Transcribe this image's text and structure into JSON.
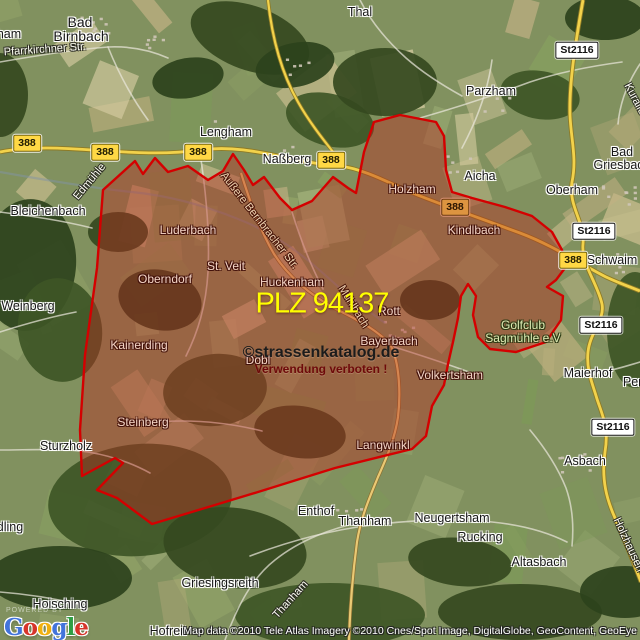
{
  "map": {
    "plz_label": {
      "text": "PLZ 94137"
    },
    "watermark": {
      "line1": "©strassenkatalog.de",
      "line2": "Verwendung verboten !"
    },
    "attribution": "Map data ©2010 Tele Atlas  Imagery ©2010 Cnes/Spot Image, DigitalGlobe, GeoContent, GeoEye",
    "google": {
      "powered": "POWERED BY",
      "letters": [
        [
          "G",
          "#4274db"
        ],
        [
          "o",
          "#d7352a"
        ],
        [
          "o",
          "#f1b10f"
        ],
        [
          "g",
          "#4274db"
        ],
        [
          "l",
          "#2f9e44"
        ],
        [
          "e",
          "#d7352a"
        ]
      ]
    },
    "colors": {
      "boundary_stroke": "#d40000",
      "boundary_fill": "rgba(185,40,30,0.42)",
      "road_primary": "#f2d24b",
      "plz_text": "#ffff00",
      "badge_yellow": "#ffd845",
      "badge_white": "#ffffff"
    },
    "labels": [
      {
        "t": "ham",
        "x": 9,
        "y": 34,
        "s": "dark"
      },
      {
        "t": "Bad",
        "x": 80,
        "y": 22,
        "s": "dark",
        "fs": 14
      },
      {
        "t": "Birnbach",
        "x": 81,
        "y": 36,
        "s": "dark",
        "fs": 14
      },
      {
        "t": "Pfarrkirchner Str.",
        "x": 45,
        "y": 50,
        "s": "street",
        "r": -4
      },
      {
        "t": "Thal",
        "x": 360,
        "y": 12,
        "s": "dark"
      },
      {
        "t": "Parzham",
        "x": 491,
        "y": 91,
        "s": "dark"
      },
      {
        "t": "Lengham",
        "x": 226,
        "y": 132,
        "s": "dark"
      },
      {
        "t": "Naßberg",
        "x": 287,
        "y": 159,
        "s": "dark"
      },
      {
        "t": "Aicha",
        "x": 480,
        "y": 176,
        "s": "dark"
      },
      {
        "t": "Oberham",
        "x": 572,
        "y": 190,
        "s": "dark"
      },
      {
        "t": "Bad",
        "x": 622,
        "y": 152,
        "s": "dark"
      },
      {
        "t": "Griesbach",
        "x": 622,
        "y": 165,
        "s": "dark"
      },
      {
        "t": "Kurallee",
        "x": 636,
        "y": 102,
        "s": "street",
        "r": 62
      },
      {
        "t": "Schwaim",
        "x": 612,
        "y": 260,
        "s": "dark"
      },
      {
        "t": "Bleichenbach",
        "x": 48,
        "y": 211,
        "s": "dark"
      },
      {
        "t": "Edmühle",
        "x": 90,
        "y": 182,
        "s": "street",
        "r": -50
      },
      {
        "t": "Weinberg",
        "x": 28,
        "y": 306,
        "s": "dark"
      },
      {
        "t": "Maierhof",
        "x": 588,
        "y": 373,
        "s": "dark"
      },
      {
        "t": "Pen",
        "x": 634,
        "y": 382,
        "s": "dark"
      },
      {
        "t": "Sturzholz",
        "x": 66,
        "y": 446,
        "s": "dark"
      },
      {
        "t": "Asbach",
        "x": 585,
        "y": 461,
        "s": "dark"
      },
      {
        "t": "Enthof",
        "x": 316,
        "y": 511,
        "s": "dark"
      },
      {
        "t": "Thanham",
        "x": 365,
        "y": 521,
        "s": "dark"
      },
      {
        "t": "Neugertsham",
        "x": 452,
        "y": 518,
        "s": "dark"
      },
      {
        "t": "Rucking",
        "x": 480,
        "y": 537,
        "s": "dark"
      },
      {
        "t": "Altasbach",
        "x": 539,
        "y": 562,
        "s": "dark"
      },
      {
        "t": "Griesingsreith",
        "x": 220,
        "y": 583,
        "s": "dark"
      },
      {
        "t": "Hoisching",
        "x": 60,
        "y": 604,
        "s": "dark"
      },
      {
        "t": "Hofreit",
        "x": 168,
        "y": 631,
        "s": "dark"
      },
      {
        "t": "dling",
        "x": 10,
        "y": 527,
        "s": "dark"
      },
      {
        "t": "Thanham",
        "x": 291,
        "y": 600,
        "s": "street",
        "r": -48
      },
      {
        "t": "Holzhausen",
        "x": 628,
        "y": 545,
        "s": "street",
        "r": 65
      },
      {
        "t": "Holzham",
        "x": 412,
        "y": 189,
        "s": "light"
      },
      {
        "t": "Kindlbach",
        "x": 474,
        "y": 230,
        "s": "light"
      },
      {
        "t": "Luderbach",
        "x": 188,
        "y": 230,
        "s": "light"
      },
      {
        "t": "Oberndorf",
        "x": 165,
        "y": 279,
        "s": "light"
      },
      {
        "t": "St. Veit",
        "x": 226,
        "y": 266,
        "s": "light"
      },
      {
        "t": "Huckenham",
        "x": 292,
        "y": 282,
        "s": "light"
      },
      {
        "t": "Kainerding",
        "x": 139,
        "y": 345,
        "s": "light"
      },
      {
        "t": "Steinberg",
        "x": 143,
        "y": 422,
        "s": "light"
      },
      {
        "t": "Rott",
        "x": 389,
        "y": 311,
        "s": "light"
      },
      {
        "t": "Bayerbach",
        "x": 389,
        "y": 341,
        "s": "light"
      },
      {
        "t": "Dobl",
        "x": 258,
        "y": 360,
        "s": "light"
      },
      {
        "t": "Volkertsham",
        "x": 450,
        "y": 375,
        "s": "light"
      },
      {
        "t": "Langwinkl",
        "x": 383,
        "y": 445,
        "s": "light"
      },
      {
        "t": "Golfclub",
        "x": 523,
        "y": 325,
        "s": "golf"
      },
      {
        "t": "Sagmühle e.V",
        "x": 523,
        "y": 338,
        "s": "golf"
      },
      {
        "t": "Außere Bernbracher Str.",
        "x": 259,
        "y": 221,
        "s": "street-light",
        "r": 52
      },
      {
        "t": "Mühlbach",
        "x": 353,
        "y": 307,
        "s": "street-light",
        "r": 58
      }
    ],
    "badges": [
      {
        "t": "388",
        "x": 27,
        "y": 143,
        "s": "b-yellow"
      },
      {
        "t": "388",
        "x": 105,
        "y": 152,
        "s": "b-yellow"
      },
      {
        "t": "388",
        "x": 198,
        "y": 152,
        "s": "b-yellow"
      },
      {
        "t": "388",
        "x": 331,
        "y": 160,
        "s": "b-yellow"
      },
      {
        "t": "388",
        "x": 573,
        "y": 260,
        "s": "b-yellow"
      },
      {
        "t": "388",
        "x": 455,
        "y": 207,
        "s": "b-orange"
      },
      {
        "t": "St2116",
        "x": 577,
        "y": 50,
        "s": "b-white"
      },
      {
        "t": "St2116",
        "x": 594,
        "y": 231,
        "s": "b-white"
      },
      {
        "t": "St2116",
        "x": 601,
        "y": 325,
        "s": "b-white"
      },
      {
        "t": "St2116",
        "x": 613,
        "y": 427,
        "s": "b-white"
      }
    ]
  }
}
